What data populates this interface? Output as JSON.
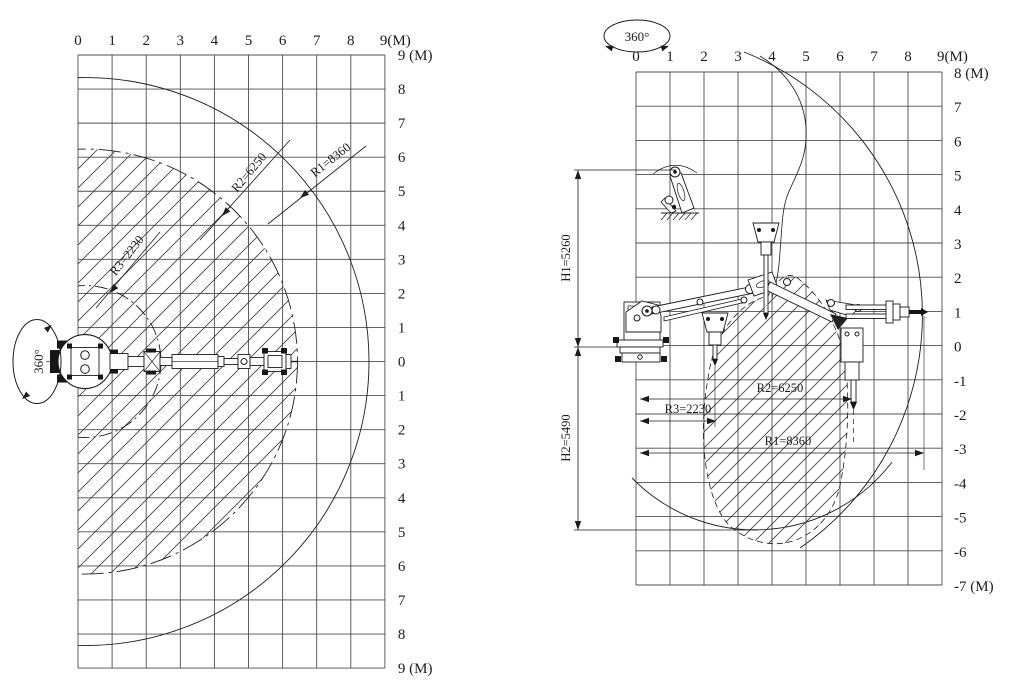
{
  "drawing": {
    "background": "#ffffff",
    "line_color": "#1c1c1c",
    "grid_color": "#4d4d4d",
    "hatch_color": "#3c3c3c"
  },
  "plan_view": {
    "rotation_label": "360°",
    "axis_unit": "(M)",
    "x_tick_labels": [
      "0",
      "1",
      "2",
      "3",
      "4",
      "5",
      "6",
      "7",
      "8",
      "9(M)"
    ],
    "y_tick_labels": [
      "9 (M)",
      "8",
      "7",
      "6",
      "5",
      "4",
      "3",
      "2",
      "1",
      "0",
      "1",
      "2",
      "3",
      "4",
      "5",
      "6",
      "7",
      "8",
      "9 (M)"
    ],
    "radius_labels": [
      {
        "name": "R3",
        "text": "R3=2230"
      },
      {
        "name": "R2",
        "text": "R2=6250"
      },
      {
        "name": "R1",
        "text": "R1=8360"
      }
    ]
  },
  "elevation_view": {
    "rotation_label": "360°",
    "axis_unit": "(M)",
    "x_tick_labels": [
      "0",
      "1",
      "2",
      "3",
      "4",
      "5",
      "6",
      "7",
      "8",
      "9(M)"
    ],
    "y_tick_labels": [
      "8 (M)",
      "7",
      "6",
      "5",
      "4",
      "3",
      "2",
      "1",
      "0",
      "-1",
      "-2",
      "-3",
      "-4",
      "-5",
      "-6",
      "-7 (M)"
    ],
    "height_labels": [
      {
        "name": "H1",
        "text": "H1=5260"
      },
      {
        "name": "H2",
        "text": "H2=5490"
      }
    ],
    "radius_labels": [
      {
        "name": "R2",
        "text": "R2=6250"
      },
      {
        "name": "R3",
        "text": "R3=2230"
      },
      {
        "name": "R1",
        "text": "R1=8360"
      }
    ]
  }
}
